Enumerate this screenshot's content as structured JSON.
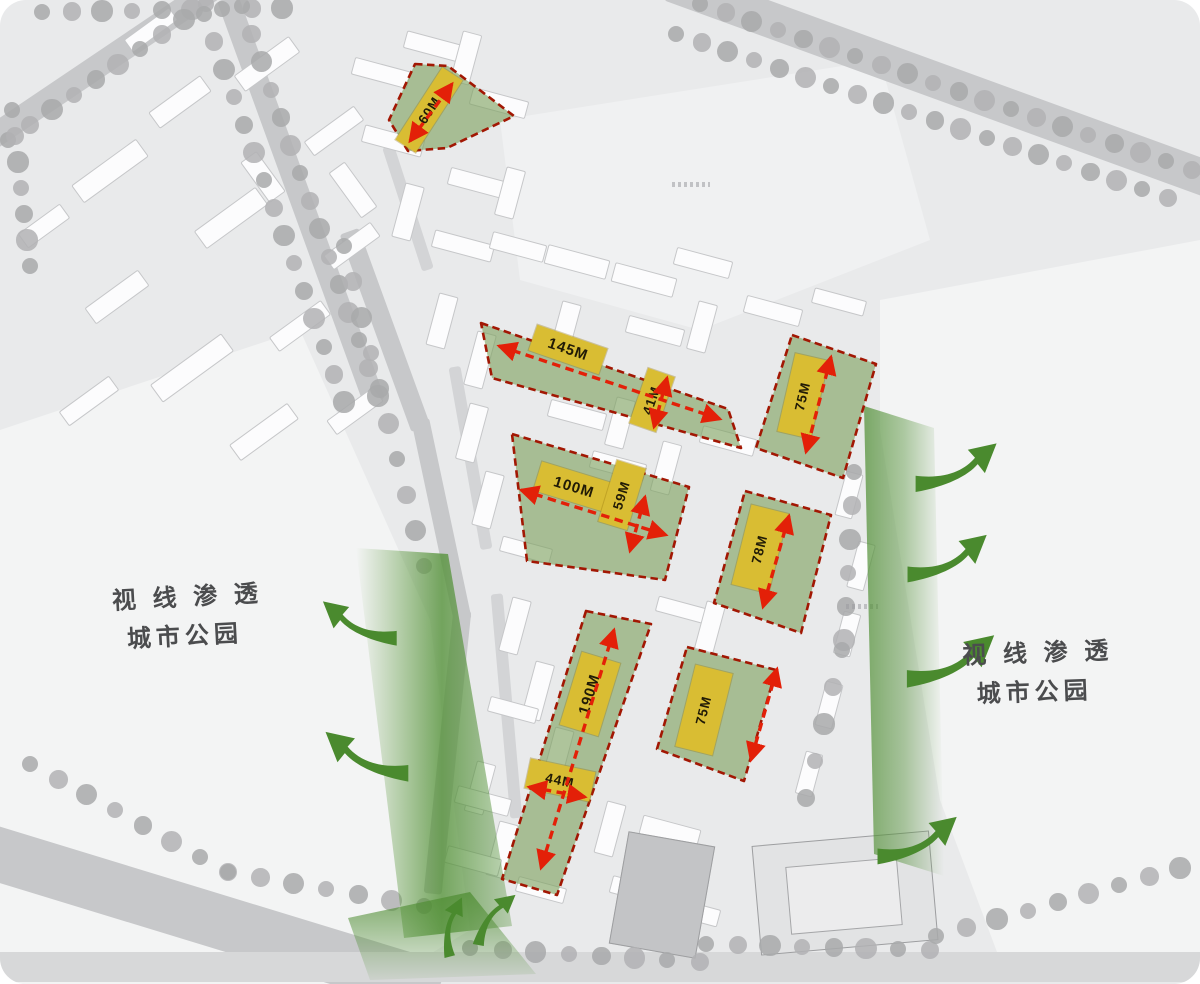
{
  "annotations": {
    "park_left": {
      "line1": "视 线 渗 透",
      "line2": "城市公园"
    },
    "park_right": {
      "line1": "视 线 渗 透",
      "line2": "城市公园"
    }
  },
  "dimensions": {
    "northwest_parcel": "60M",
    "north_band_length": "145M",
    "north_band_width": "41M",
    "northeast_parcel": "75M",
    "central_parcel_length": "100M",
    "central_parcel_width": "59M",
    "east_parcel": "78M",
    "south_strip_length": "190M",
    "south_strip_width": "44M",
    "southeast_parcel": "75M"
  },
  "colors": {
    "parcel_green": "#7ea25f",
    "dimension_yellow": "#d9bd33",
    "arrow_red": "#e32008",
    "parcel_border_red": "#a21703",
    "flow_green": "#4a8a2e",
    "label_gray": "#4b4c4e"
  }
}
